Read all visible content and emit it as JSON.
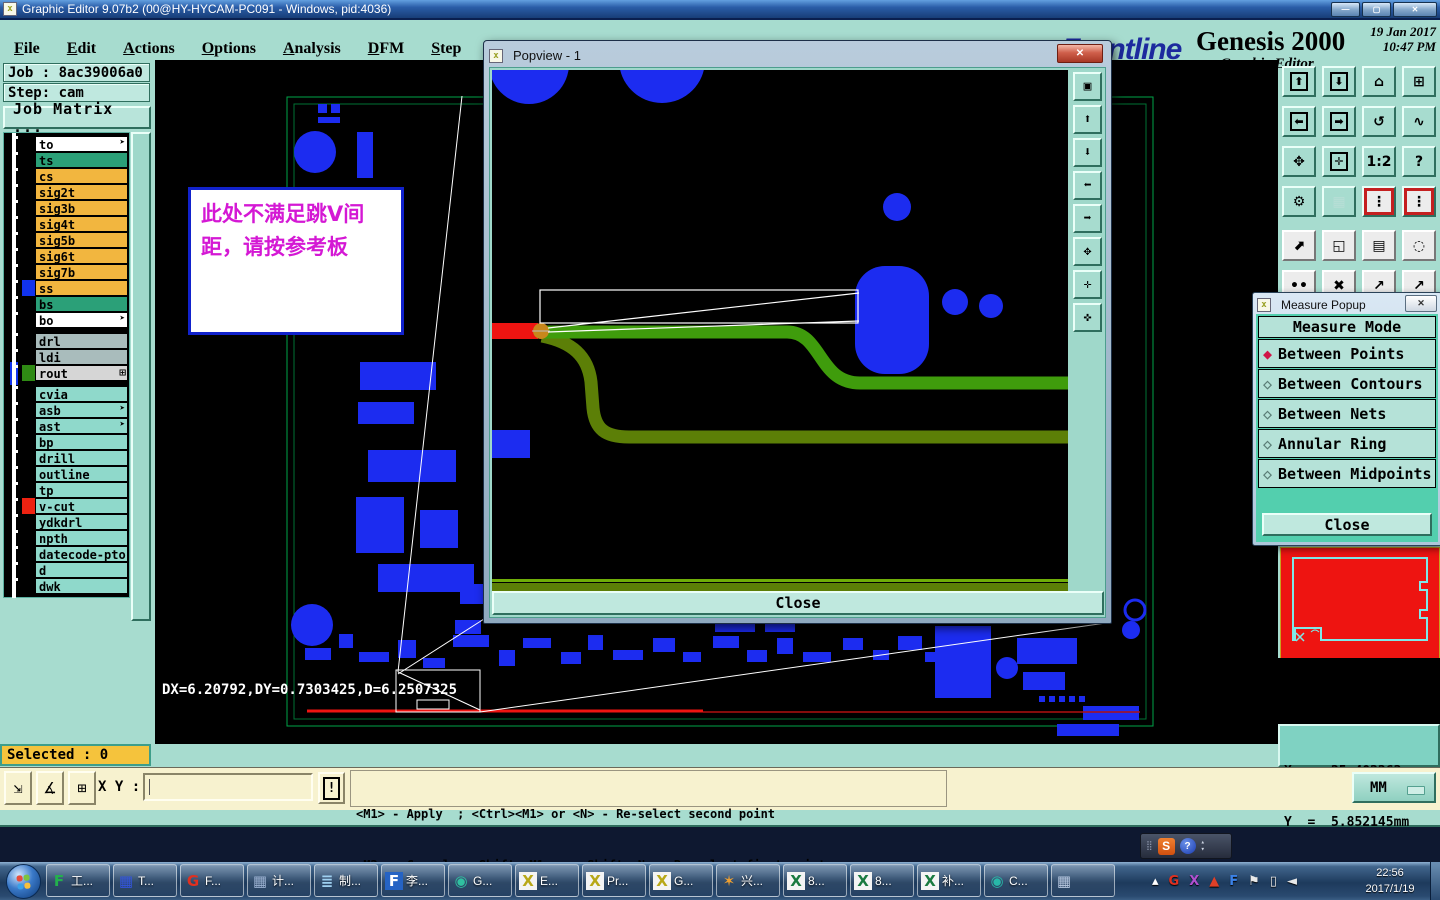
{
  "window": {
    "title": "Graphic Editor 9.07b2 (00@HY-HYCAM-PC091 - Windows, pid:4036)",
    "icon_glyph": "x",
    "controls": [
      {
        "name": "minimize-button",
        "glyph": "—"
      },
      {
        "name": "maximize-button",
        "glyph": "▢"
      },
      {
        "name": "close-button",
        "glyph": "✕"
      }
    ]
  },
  "menubar": {
    "items": [
      {
        "label": "File"
      },
      {
        "label": "Edit"
      },
      {
        "label": "Actions"
      },
      {
        "label": "Options"
      },
      {
        "label": "Analysis"
      },
      {
        "label": "DFM"
      },
      {
        "label": "Step"
      },
      {
        "label": "Rout"
      },
      {
        "label": "Windows"
      }
    ],
    "help": "Help"
  },
  "brand": {
    "stripes_glyph": "☰",
    "logo": "Frontline",
    "product": "Genesis 2000",
    "subtitle": "Graphic Editor",
    "date": "19 Jan 2017",
    "time": "10:47 PM"
  },
  "job_panel": {
    "job": "Job : 8ac39006a0",
    "step": "Step: cam",
    "matrix_button": "Job Matrix ..."
  },
  "layers": {
    "group1": [
      {
        "name": "to",
        "bg": "#ffffff",
        "arrow": "➤"
      },
      {
        "name": "ts",
        "bg": "#2ba078"
      },
      {
        "name": "cs",
        "bg": "#f2b63f"
      },
      {
        "name": "sig2t",
        "bg": "#f2b63f"
      },
      {
        "name": "sig3b",
        "bg": "#f2b63f"
      },
      {
        "name": "sig4t",
        "bg": "#f2b63f"
      },
      {
        "name": "sig5b",
        "bg": "#f2b63f"
      },
      {
        "name": "sig6t",
        "bg": "#f2b63f"
      },
      {
        "name": "sig7b",
        "bg": "#f2b63f"
      },
      {
        "name": "ss",
        "bg": "#f2b63f",
        "swatch": "#1133ee"
      },
      {
        "name": "bs",
        "bg": "#2ba078"
      },
      {
        "name": "bo",
        "bg": "#ffffff",
        "arrow": "➤"
      }
    ],
    "group2": [
      {
        "name": "drl",
        "bg": "#a9bcbc"
      },
      {
        "name": "ldi",
        "bg": "#a9bcbc"
      },
      {
        "name": "rout",
        "bg": "#d6d6d6",
        "swatch": "#2f8a14",
        "box": "#1133ee",
        "grid": "⊞"
      }
    ],
    "group3": [
      {
        "name": "cvia",
        "bg": "#8fd9cb"
      },
      {
        "name": "asb",
        "bg": "#8fd9cb",
        "arrow": "➤"
      },
      {
        "name": "ast",
        "bg": "#8fd9cb",
        "arrow": "➤"
      },
      {
        "name": "bp",
        "bg": "#8fd9cb"
      },
      {
        "name": "drill",
        "bg": "#8fd9cb"
      },
      {
        "name": "outline",
        "bg": "#8fd9cb"
      },
      {
        "name": "tp",
        "bg": "#8fd9cb"
      },
      {
        "name": "v-cut",
        "bg": "#8fd9cb",
        "swatch": "#ee2211"
      },
      {
        "name": "ydkdrl",
        "bg": "#8fd9cb"
      },
      {
        "name": "npth",
        "bg": "#8fd9cb"
      },
      {
        "name": "datecode-pto",
        "bg": "#8fd9cb"
      },
      {
        "name": "d",
        "bg": "#8fd9cb"
      },
      {
        "name": "dwk",
        "bg": "#8fd9cb"
      }
    ]
  },
  "status": {
    "selected": "Selected : 0"
  },
  "canvas": {
    "dx_readout": "DX=6.20792,DY=0.7303425,D=6.2507325",
    "annotation": "此处不满足跳V间距，请按参考板"
  },
  "popview": {
    "title": "Popview - 1",
    "icon_glyph": "x",
    "close_x": "✕",
    "close_button": "Close",
    "tools": [
      {
        "name": "duplicate-view-icon",
        "glyph": "▣"
      },
      {
        "name": "zoom-in-icon",
        "glyph": "⬆"
      },
      {
        "name": "zoom-out-icon",
        "glyph": "⬇"
      },
      {
        "name": "pan-left-icon",
        "glyph": "⬅"
      },
      {
        "name": "pan-right-icon",
        "glyph": "➡"
      },
      {
        "name": "zoom-extents-icon",
        "glyph": "✥"
      },
      {
        "name": "zoom-center-icon",
        "glyph": "✛"
      },
      {
        "name": "pan-free-icon",
        "glyph": "✜"
      }
    ]
  },
  "measure_popup": {
    "title": "Measure Popup",
    "icon_glyph": "x",
    "close_x": "✕",
    "header": "Measure Mode",
    "modes": [
      {
        "label": "Between Points",
        "glyph": "◆",
        "color": "#d01648"
      },
      {
        "label": "Between Contours",
        "glyph": "◇",
        "color": "#5a7d76"
      },
      {
        "label": "Between Nets",
        "glyph": "◇",
        "color": "#5a7d76"
      },
      {
        "label": "Annular Ring",
        "glyph": "◇",
        "color": "#5a7d76"
      },
      {
        "label": "Between Midpoints",
        "glyph": "◇",
        "color": "#5a7d76"
      }
    ],
    "close_button": "Close"
  },
  "readout": {
    "x": "X  =  25.402262mm",
    "y": "Y  =  5.852145mm"
  },
  "command_bar": {
    "tools": [
      {
        "name": "resize-mode-icon",
        "glyph": "⇲"
      },
      {
        "name": "angle-mode-icon",
        "glyph": "∡"
      },
      {
        "name": "grid-mode-icon",
        "glyph": "⊞"
      }
    ],
    "xy_label": "X Y :",
    "input_value": "",
    "alert_glyph": "!",
    "message_line1": "<M1> - Apply  ; <Ctrl><M1> or <N> - Re-select second point",
    "message_line2": "<M2> - Cancel ; <Shift><M1> or <Shift><N> - Re-select first point",
    "units": "MM"
  },
  "toolbar_right": {
    "teal": [
      {
        "name": "zoom-in-icon",
        "glyph": "⬆",
        "boxed": "1"
      },
      {
        "name": "zoom-out-icon",
        "glyph": "⬇",
        "boxed": "1"
      },
      {
        "name": "home-view-icon",
        "glyph": "⌂"
      },
      {
        "name": "xy-window-icon",
        "glyph": "⊞"
      },
      {
        "name": "pan-left-icon",
        "glyph": "⬅",
        "boxed": "1"
      },
      {
        "name": "pan-right-icon",
        "glyph": "➡",
        "boxed": "1"
      },
      {
        "name": "undo-view-icon",
        "glyph": "↺"
      },
      {
        "name": "serpentine-icon",
        "glyph": "∿"
      },
      {
        "name": "zoom-extents-icon",
        "glyph": "✥"
      },
      {
        "name": "zoom-center-icon",
        "glyph": "✛",
        "boxed": "1"
      },
      {
        "name": "scale-1-2-icon",
        "glyph": "1:2"
      },
      {
        "name": "help-icon",
        "glyph": "?"
      },
      {
        "name": "tools-icon",
        "glyph": "⚙"
      },
      {
        "name": "grid-icon",
        "glyph": "▦",
        "variant": "pale"
      },
      {
        "name": "signal-lights-icon",
        "glyph": "⋮",
        "variant": "red"
      },
      {
        "name": "signal-lights2-icon",
        "glyph": "⋮",
        "variant": "red"
      }
    ],
    "gray": [
      {
        "name": "move-object-icon",
        "glyph": "⬈"
      },
      {
        "name": "frame-select-icon",
        "glyph": "◱"
      },
      {
        "name": "ruler-icon",
        "glyph": "▤"
      },
      {
        "name": "pad-select-icon",
        "glyph": "◌"
      },
      {
        "name": "pins-icon",
        "glyph": "••"
      },
      {
        "name": "delete-icon",
        "glyph": "✖"
      },
      {
        "name": "point-move-icon",
        "glyph": "↗"
      },
      {
        "name": "point-move2-icon",
        "glyph": "↗"
      }
    ]
  },
  "taskbar": {
    "items": [
      {
        "name": "task-foxmail",
        "glyph": "F",
        "color": "#23b14d",
        "label": "工..."
      },
      {
        "name": "task-save",
        "glyph": "▦",
        "color": "#3355dd",
        "label": "T..."
      },
      {
        "name": "task-flashget",
        "glyph": "G",
        "color": "#e03020",
        "label": "F..."
      },
      {
        "name": "task-calculator",
        "glyph": "▦",
        "color": "#9ab0d0",
        "label": "计..."
      },
      {
        "name": "task-notes",
        "glyph": "≣",
        "color": "#9fd0f0",
        "label": "制..."
      },
      {
        "name": "task-f-tile",
        "glyph": "F",
        "color": "#ffffff",
        "tile": "#2563c4",
        "label": "李..."
      },
      {
        "name": "task-media",
        "glyph": "◉",
        "color": "#30c0a0",
        "label": "G..."
      },
      {
        "name": "task-xwin-e",
        "glyph": "X",
        "color": "#b8a818",
        "tile": "#f4f4f4",
        "label": "E..."
      },
      {
        "name": "task-xwin-pr",
        "glyph": "X",
        "color": "#b8a818",
        "tile": "#f4f4f4",
        "label": "Pr..."
      },
      {
        "name": "task-xwin-g",
        "glyph": "X",
        "color": "#b8a818",
        "tile": "#f4f4f4",
        "label": "G..."
      },
      {
        "name": "task-shell",
        "glyph": "✶",
        "color": "#f0a030",
        "label": "兴..."
      },
      {
        "name": "task-excel-1",
        "glyph": "X",
        "color": "#1a7a40",
        "tile": "#f4f4f4",
        "label": "8..."
      },
      {
        "name": "task-excel-2",
        "glyph": "X",
        "color": "#1a7a40",
        "tile": "#f4f4f4",
        "label": "8..."
      },
      {
        "name": "task-excel-3",
        "glyph": "X",
        "color": "#1a7a40",
        "tile": "#f4f4f4",
        "label": "补..."
      },
      {
        "name": "task-cd",
        "glyph": "◉",
        "color": "#28b8a8",
        "label": "C..."
      },
      {
        "name": "task-calc2",
        "glyph": "▦",
        "color": "#b8c8e0",
        "label": ""
      }
    ],
    "tray": [
      {
        "name": "tray-expand-icon",
        "glyph": "▴",
        "color": "#ffffff"
      },
      {
        "name": "tray-g-icon",
        "glyph": "G",
        "color": "#e03020"
      },
      {
        "name": "tray-x-icon",
        "glyph": "X",
        "color": "#b050d0"
      },
      {
        "name": "tray-triangle-icon",
        "glyph": "▲",
        "color": "#e04028"
      },
      {
        "name": "tray-f-icon",
        "glyph": "F",
        "color": "#3b82e8"
      },
      {
        "name": "tray-flag-icon",
        "glyph": "⚑",
        "color": "#e8e8e8"
      },
      {
        "name": "tray-network-icon",
        "glyph": "▯",
        "color": "#e8e8e8"
      },
      {
        "name": "tray-volume-icon",
        "glyph": "◄",
        "color": "#e8e8e8"
      }
    ],
    "time": "22:56",
    "date": "2017/1/19"
  },
  "ime": {
    "grip_glyph": "⣿",
    "s_glyph": "S",
    "help_glyph": "?",
    "up_glyph": "▴",
    "down_glyph": "▾"
  }
}
